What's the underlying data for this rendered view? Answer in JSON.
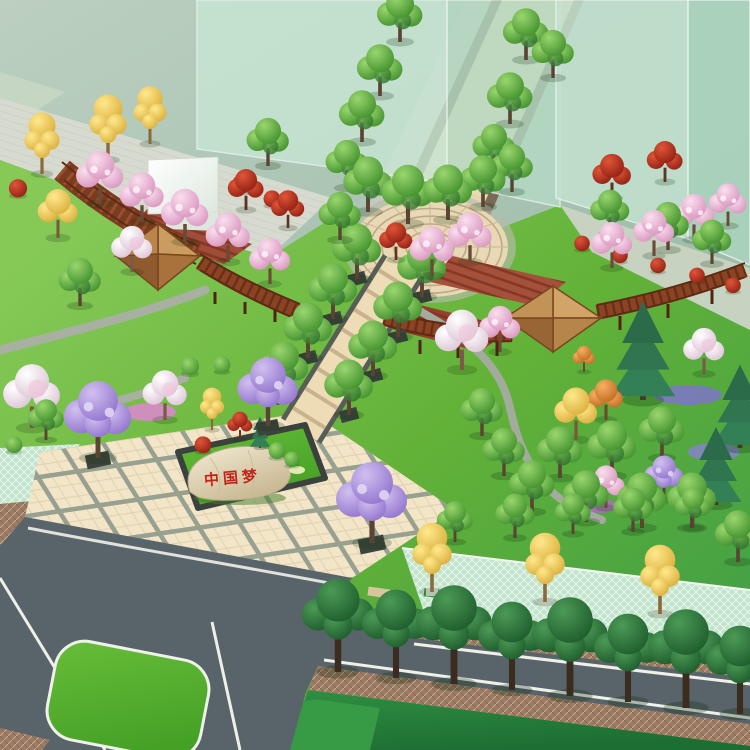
{
  "scene": {
    "description": "Bird's-eye architectural rendering of a park and plaza landscape design",
    "stone_inscription": "中国梦",
    "palette": {
      "context_ground": "#a7c0af",
      "lawn": "#68b43c",
      "lawn_dark": "#2f8f42",
      "plaza_tile": "#f2e5c8",
      "walkway_tile": "#eddcb6",
      "entry_road": "#e8d9b3",
      "asphalt": "#59646a",
      "sidewalk_brown": "#9b7b64",
      "grass_paver_mint": "#c2e4cc",
      "pergola_wood": "#8a4424",
      "pavilion_roof": "#c39257",
      "building_glass": "#c2e1cf",
      "inscription_red": "#c3241a",
      "island_grass": "#57b02e",
      "cherry_pink": "#e9aed0",
      "jacaranda_purple": "#b094de",
      "ginkgo_yellow": "#f2cf52",
      "maple_red": "#c23a24"
    },
    "features": [
      "translucent building massing blocks",
      "paved diagonal entry walkway",
      "fan-pattern circular plaza",
      "timber pergola corridors with hip-roof pavilions",
      "white canopy tent",
      "tree-lined boulevard with square planters",
      "main tiled plaza",
      "green island with inscribed feature stone",
      "jacaranda trees in planters",
      "asphalt roads with white lane markings",
      "grass median island",
      "grass-paver strips with ginkgo street trees",
      "street tree rows",
      "flower beds and mixed ornamental planting"
    ]
  }
}
